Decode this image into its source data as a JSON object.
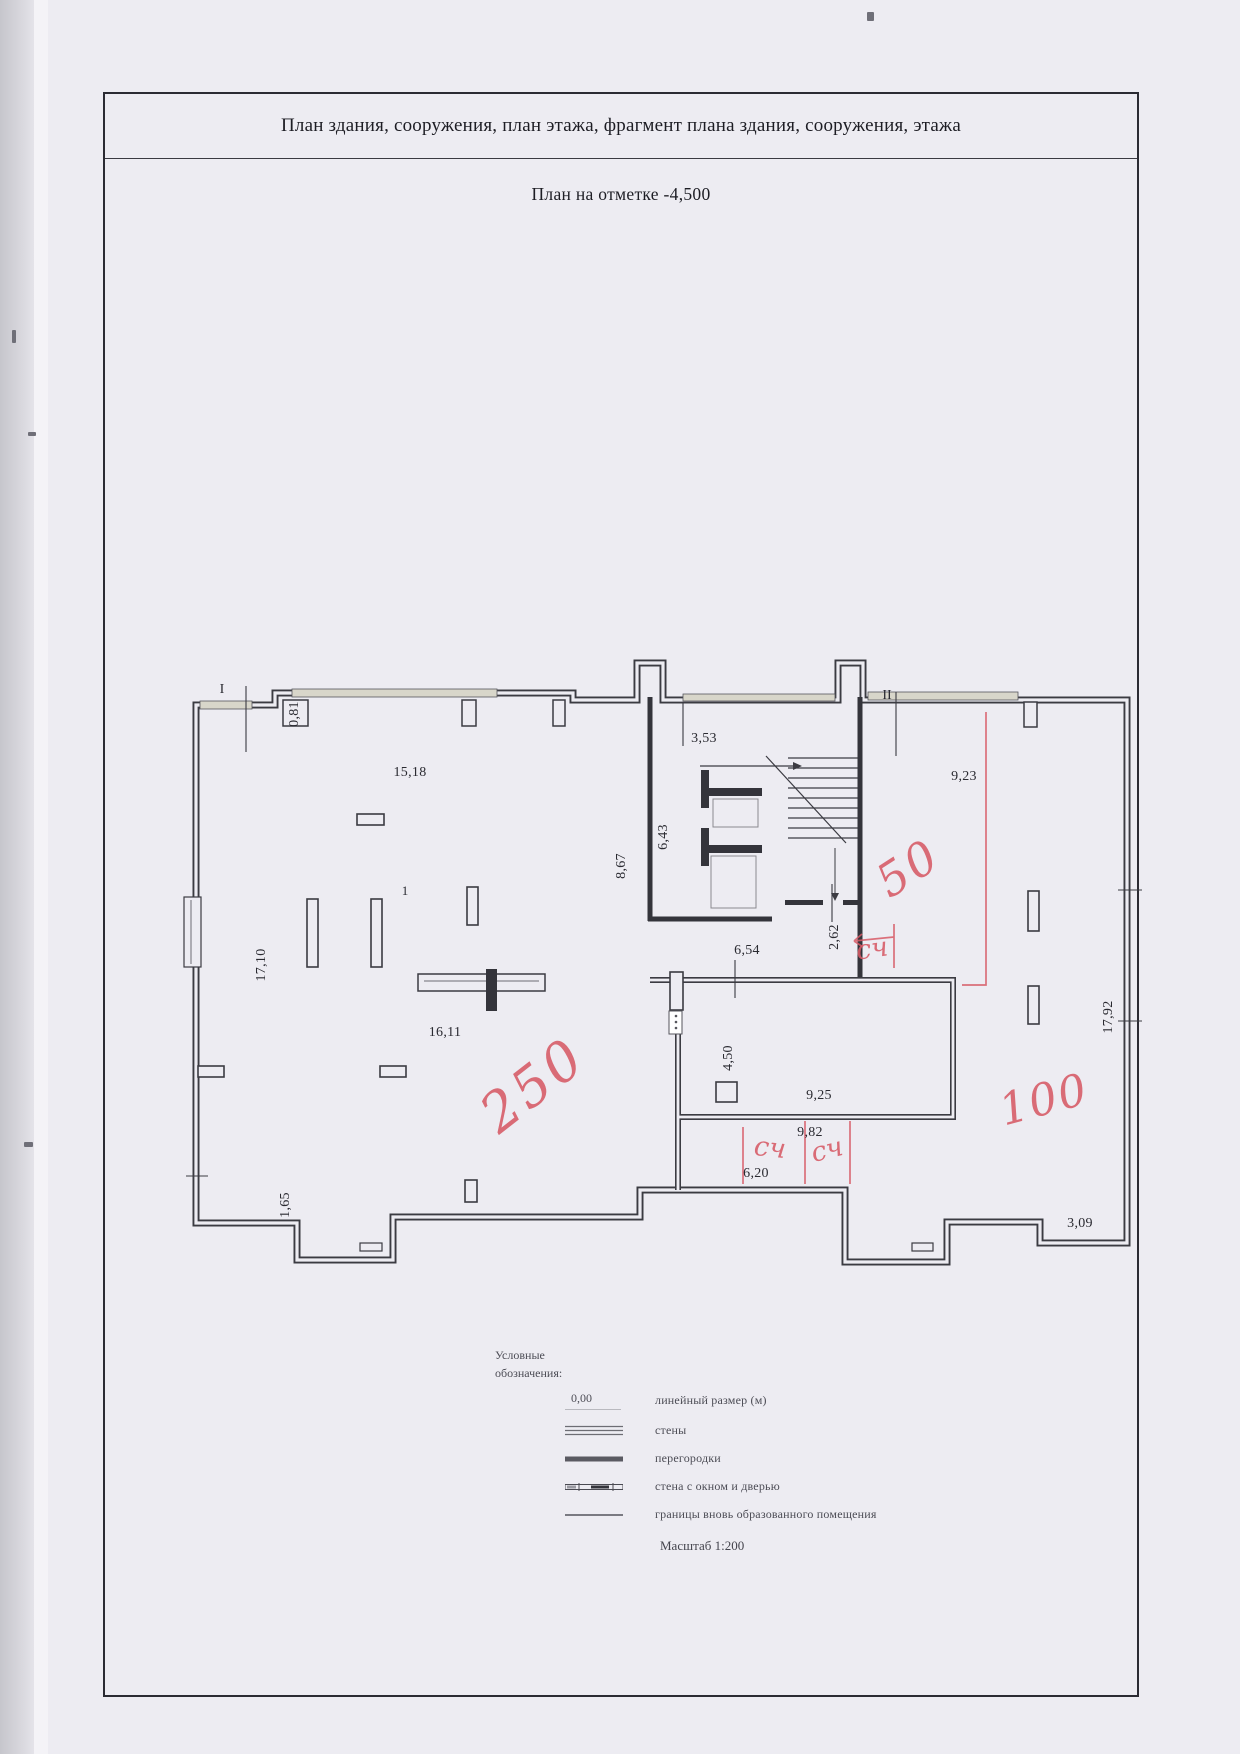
{
  "page": {
    "title": "План здания, сооружения, план этажа, фрагмент плана здания, сооружения, этажа",
    "subtitle": "План  на отметке -4,500"
  },
  "plan": {
    "markers": [
      {
        "text": "I"
      },
      {
        "text": "II"
      }
    ],
    "room_label": {
      "text": "1"
    },
    "dimensions": [
      {
        "text": "0,81"
      },
      {
        "text": "15,18"
      },
      {
        "text": "3,53"
      },
      {
        "text": "9,23"
      },
      {
        "text": "6,43"
      },
      {
        "text": "8,67"
      },
      {
        "text": "17,10"
      },
      {
        "text": "6,54"
      },
      {
        "text": "2,62"
      },
      {
        "text": "16,11"
      },
      {
        "text": "4,50"
      },
      {
        "text": "9,25"
      },
      {
        "text": "9,82"
      },
      {
        "text": "6,20"
      },
      {
        "text": "1,65"
      },
      {
        "text": "17,92"
      },
      {
        "text": "3,09"
      }
    ],
    "red_annotations": [
      {
        "text": "250"
      },
      {
        "text": "50"
      },
      {
        "text": "100"
      },
      {
        "text": "сч"
      },
      {
        "text": "сч"
      },
      {
        "text": "сч"
      }
    ]
  },
  "legend": {
    "heading": "Условные обозначения:",
    "items": [
      {
        "sample": "0,00",
        "label": "линейный размер (м)",
        "symbol": "linear-dimension"
      },
      {
        "label": "стены",
        "symbol": "walls-double-line"
      },
      {
        "label": "перегородки",
        "symbol": "partition-thick-line"
      },
      {
        "label": "стена с окном и дверью",
        "symbol": "wall-with-window-and-door"
      },
      {
        "label": "границы вновь образованного помещения",
        "symbol": "new-room-boundary-line"
      }
    ],
    "scale": "Масштаб 1:200"
  },
  "colors": {
    "paper": "#edecf2",
    "ink": "#3b3b42",
    "annotation_red": "#d75a66",
    "window_band": "#d8d6ca"
  }
}
